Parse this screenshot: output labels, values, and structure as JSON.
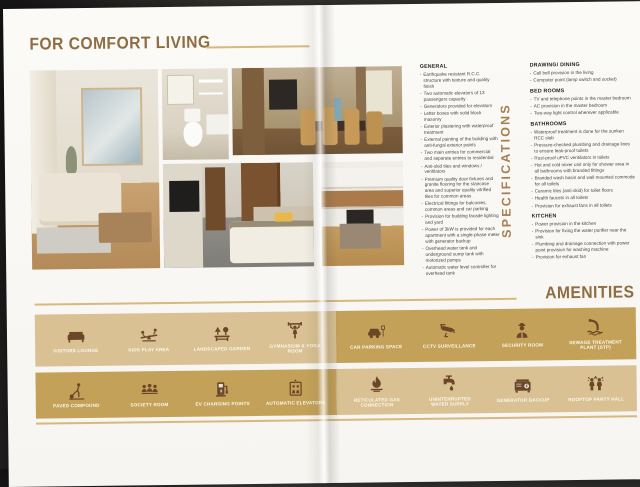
{
  "page": {
    "title": "FOR COMFORT LIVING"
  },
  "colors": {
    "accent_gold": "#d5b97e",
    "band_light": "#d9c193",
    "band_dark": "#c3a158",
    "heading_brown": "#8f6c42",
    "icon_brown": "#6b4627",
    "label_white": "#fdf8ee"
  },
  "specifications": {
    "vertical_label": "SPECIFICATIONS",
    "general": {
      "heading": "GENERAL",
      "items": [
        "Earthquake resistant R.C.C. structure with texture and quality finish",
        "Two automatic elevators of 13 passengers capacity",
        "Generators provided for elevators",
        "Letter boxes with solid block masonry",
        "Exterior plastering with waterproof treatment",
        "External painting of the building with anti-fungal exterior paints",
        "Two main entries for commercial and separate entries to residential",
        "Anti-skid tiles and windows / ventilators",
        "Premium quality door fixtures and granite flooring for the staircase area and superior quality vitrified tiles for common areas",
        "Electrical fittings for balconies, common areas and car parking",
        "Provision for building facade lighting and yard",
        "Power of 3kW is provided for each apartment with a single-phase meter with generator backup",
        "Overhead water tank and underground sump tank with motorized pumps",
        "Automatic water level controller for overhead tank"
      ]
    },
    "sections": [
      {
        "heading": "DRAWING/ DINING",
        "items": [
          "Call bell provision in the living",
          "Computer point (lamp switch and socket)"
        ]
      },
      {
        "heading": "BED ROOMS",
        "items": [
          "TV and telephone points in the master bedroom",
          "AC provision in the master bedroom",
          "Two-way light control wherever applicable"
        ]
      },
      {
        "heading": "BATHROOMS",
        "items": [
          "Waterproof treatment is done for the sunken RCC slab",
          "Pressure-checked plumbing and drainage lines to ensure leak-proof toilets",
          "Rust-proof uPVC ventilators in toilets",
          "Hot and cold mixer unit only for shower area in all bathrooms with branded fittings",
          "Branded wash basin and wall mounted commode for all toilets",
          "Ceramic tiles (anti-skid) for toilet floors",
          "Health faucets in all toilets",
          "Provision for exhaust fans in all toilets"
        ]
      },
      {
        "heading": "KITCHEN",
        "items": [
          "Power provision in the kitchen",
          "Provision for fixing the water purifier near the sink",
          "Plumbing and drainage connection with power point provision for washing machine",
          "Provision for exhaust fan"
        ]
      }
    ]
  },
  "amenities": {
    "title": "AMENITIES",
    "groups": [
      {
        "shade": "light",
        "items": [
          {
            "icon": "sofa-icon",
            "label": "VISITORS LOUNGE"
          },
          {
            "icon": "seesaw-icon",
            "label": "KIDS PLAY AREA"
          },
          {
            "icon": "garden-icon",
            "label": "LANDSCAPED GARDEN"
          },
          {
            "icon": "gym-icon",
            "label": "GYMNASIUM & YOGA ROOM"
          }
        ]
      },
      {
        "shade": "dark",
        "items": [
          {
            "icon": "car-parking-icon",
            "label": "CAR PARKING SPACE"
          },
          {
            "icon": "cctv-icon",
            "label": "CCTV SURVEILLANCE"
          },
          {
            "icon": "security-guard-icon",
            "label": "SECURITY ROOM"
          },
          {
            "icon": "sewage-icon",
            "label": "SEWAGE TREATMENT PLANT (STP)"
          }
        ]
      },
      {
        "shade": "dark",
        "items": [
          {
            "icon": "paved-compound-icon",
            "label": "PAVED COMPOUND"
          },
          {
            "icon": "society-icon",
            "label": "SOCIETY ROOM"
          },
          {
            "icon": "ev-charging-icon",
            "label": "EV CHARGING POINTS"
          },
          {
            "icon": "elevator-icon",
            "label": "AUTOMATIC ELEVATORS"
          }
        ]
      },
      {
        "shade": "light",
        "items": [
          {
            "icon": "gas-icon",
            "label": "RETICULATED GAS CONNECTION"
          },
          {
            "icon": "water-tap-icon",
            "label": "UNINTERRUPTED WATER SUPPLY"
          },
          {
            "icon": "generator-icon",
            "label": "GENERATOR BACKUP"
          },
          {
            "icon": "party-icon",
            "label": "ROOFTOP PARTY HALL"
          }
        ]
      }
    ]
  }
}
